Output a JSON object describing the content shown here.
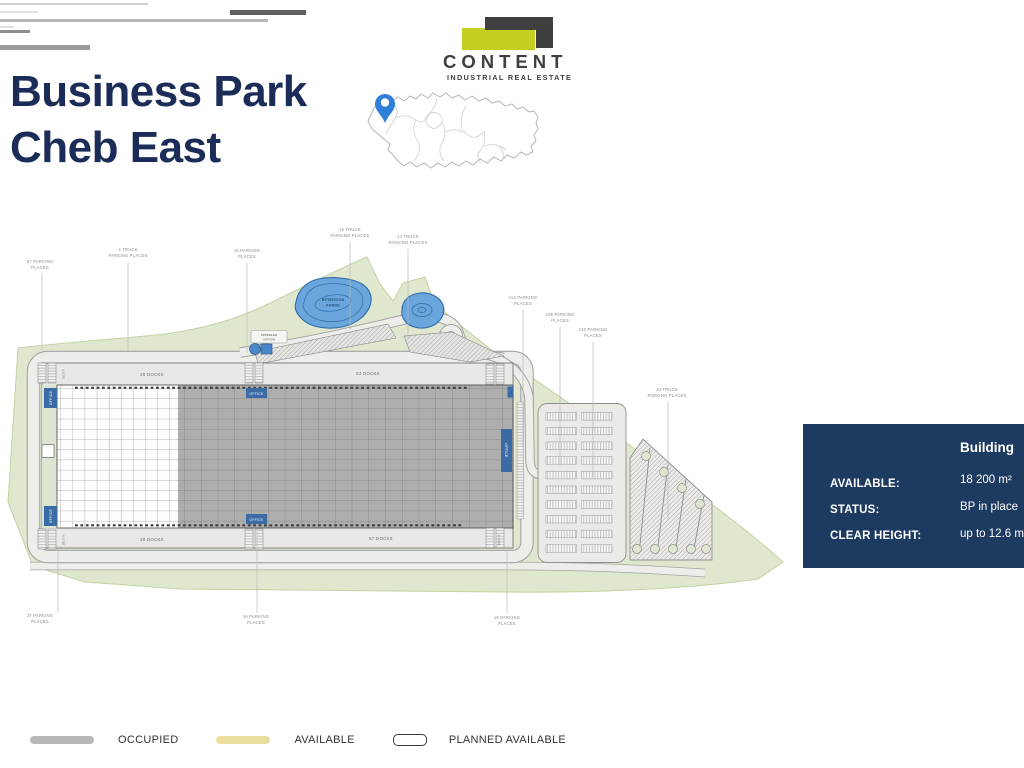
{
  "header": {
    "title_line1": "Business Park",
    "title_line2": "Cheb East"
  },
  "logo": {
    "name": "CONTENT",
    "tagline": "INDUSTRIAL REAL ESTATE"
  },
  "info_panel": {
    "column_header": "Building",
    "rows": [
      {
        "label": "AVAILABLE:",
        "value": "18 200 m²"
      },
      {
        "label": "STATUS:",
        "value": "BP in place"
      },
      {
        "label": "CLEAR HEIGHT:",
        "value": "up to 12.6 m"
      }
    ]
  },
  "legend": {
    "occupied": "OCCUPIED",
    "available": "AVAILABLE",
    "planned": "PLANNED AVAILABLE"
  },
  "site_plan": {
    "office": "OFFICE",
    "deck_in": "DECK IN",
    "retention": {
      "l1": "RETENTION",
      "l2": "PONDS"
    },
    "sprinkler": {
      "l1": "SPRINKLER",
      "l2": "STATION"
    },
    "docks": {
      "planned_top": "29 DOCKS",
      "occupied_top": "53 DOCKS",
      "planned_bottom": "29 DOCKS",
      "occupied_bottom": "57 DOCKS"
    },
    "labels": [
      {
        "l1": "57 PARKING",
        "l2": "PLACES"
      },
      {
        "l1": "4 TRUCK",
        "l2": "PARKING PLACES"
      },
      {
        "l1": "16 PARKING",
        "l2": "PLACES"
      },
      {
        "l1": "16 TRUCK",
        "l2": "PARKING PLACES"
      },
      {
        "l1": "14 TRUCK",
        "l2": "PARKING PLACES"
      },
      {
        "l1": "112 PARKING",
        "l2": "PLACES"
      },
      {
        "l1": "195 PARKING",
        "l2": "PLACES"
      },
      {
        "l1": "240 PARKING",
        "l2": "PLACES"
      },
      {
        "l1": "34 TRUCK",
        "l2": "PARKING PLACES"
      },
      {
        "l1": "37 PARKING",
        "l2": "PLACES"
      },
      {
        "l1": "16 PARKING",
        "l2": "PLACES"
      },
      {
        "l1": "16 PARKING",
        "l2": "PLACES"
      }
    ]
  },
  "colors": {
    "title_navy": "#1b2c59",
    "logo_accent": "#c3d021",
    "logo_dark": "#3f3f3f",
    "panel_navy": "#1d3b60",
    "occupied_gray": "#aeaeae",
    "available_yellow": "#ecdf9e",
    "office_blue": "#3a6ba5",
    "pond_blue": "#6aa5dc",
    "site_green": "#dfe8cf",
    "pin_blue": "#2e7fd8"
  }
}
